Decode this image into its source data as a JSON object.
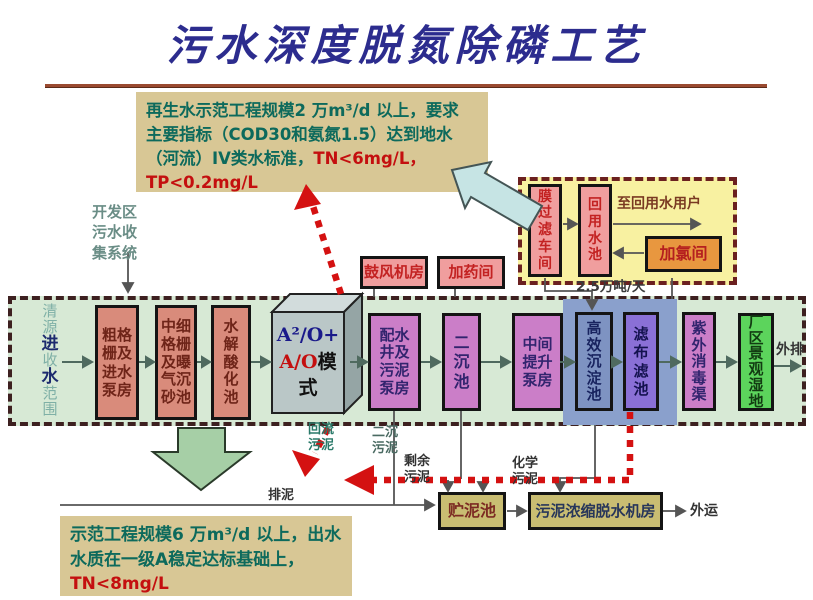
{
  "title": "污水深度脱氮除磷工艺",
  "colors": {
    "title_blue": "#2c2c8e",
    "accent_red": "#d41111",
    "note_bg": "#d8c795",
    "band_green": "#d7e9d5",
    "container_yellow": "#f8f1a1",
    "panel_blue": "#8aa0cc"
  },
  "note_top": {
    "line1": "再生水示范工程规模2 万m³/d 以上，要求",
    "line2": "主要指标（COD30和氨氮1.5）达到地水",
    "line3_teal": "（河流）IV类水标准，",
    "line3_red": "TN<6mg/L，",
    "line4_red": "TP<0.2mg/L"
  },
  "note_bottom": {
    "line1": "示范工程规模6 万m³/d 以上，出水",
    "line2": "水质在一级A稳定达标基础上，",
    "line3_red": "TN<8mg/L"
  },
  "intake_chars": [
    "清",
    "源",
    "进",
    "收",
    "水",
    "范",
    "围"
  ],
  "a2o": {
    "line1": "A²/O+",
    "line2_red": "A/O",
    "line2_black": "模",
    "line3": "式"
  },
  "nodes": {
    "coarse_screen": "粗格\n栅及\n进水\n泵房",
    "fine_screen": "中细\n格栅\n及曝\n气沉\n砂池",
    "hydrolysis": "水\n解\n酸\n化\n池",
    "distribution": "配水\n井及\n污泥\n泵房",
    "secondary_tank": "二\n沉\n池",
    "intermediate_pump": "中间\n提升\n泵房",
    "high_eff_sed": "高\n效\n沉\n淀\n池",
    "cloth_filter": "滤\n布\n滤\n池",
    "uv_channel": "紫\n外\n消\n毒\n渠",
    "wetland": "厂\n区\n景\n观\n湿\n地",
    "blower": "鼓风机房",
    "dosing": "加药间",
    "membrane": "膜\n过\n滤\n车\n间",
    "reuse_pool": "回\n用\n水\n池",
    "chlorination": "加氯间",
    "sludge_storage": "贮泥池",
    "dewatering": "污泥浓缩脱水机房"
  },
  "labels": {
    "collection_system": "开发区\n污水收\n集系统",
    "reuse_users": "至回用水用户",
    "capacity": "2.5万吨/天",
    "return_sludge": "回流\n污泥",
    "secondary_sludge": "二沉\n污泥",
    "excess_sludge": "剩余\n污泥",
    "chemical_sludge": "化学\n污泥",
    "sludge_discharge": "排泥",
    "outbound": "外运",
    "discharge": "外排"
  }
}
